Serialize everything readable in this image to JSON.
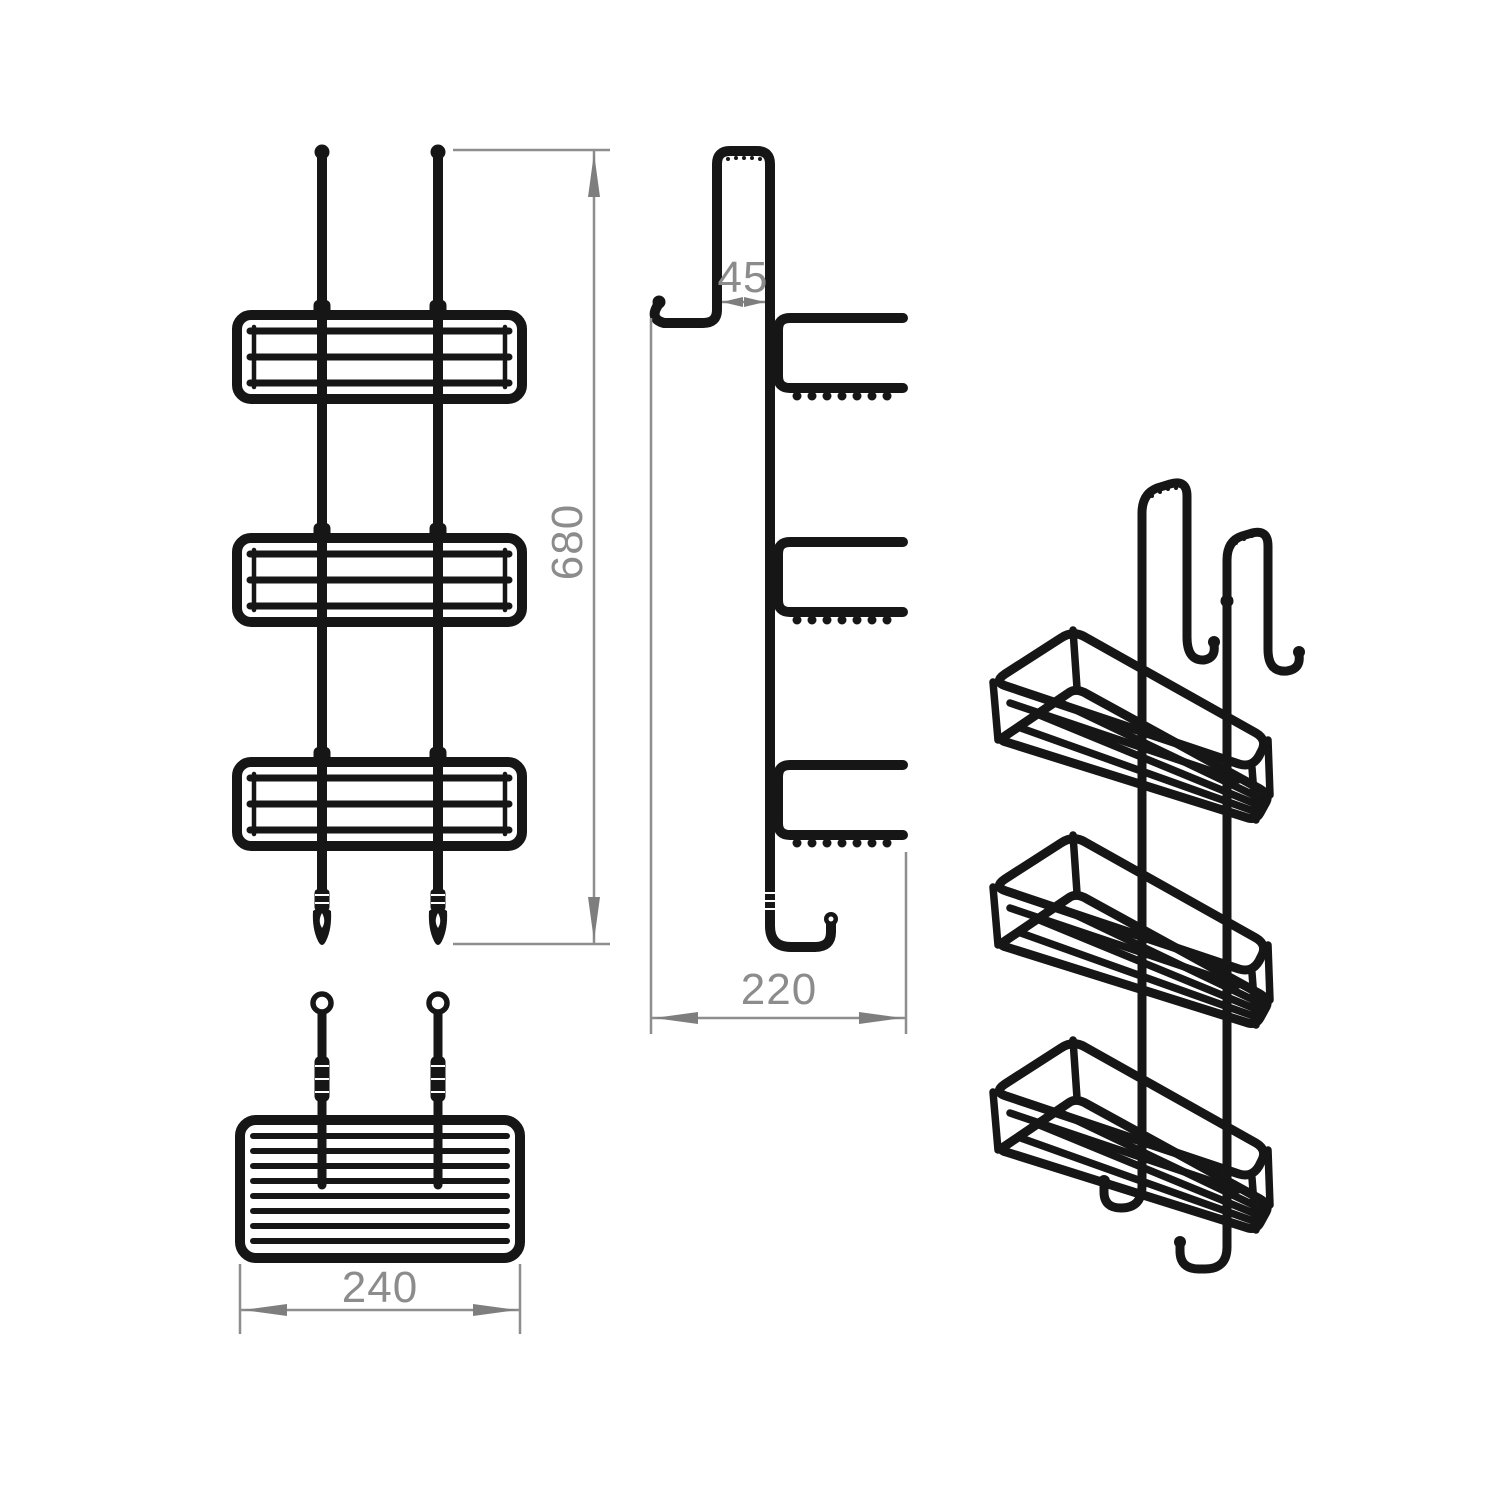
{
  "dimensions": {
    "height": "680",
    "hook_width": "45",
    "depth": "220",
    "width": "240"
  },
  "colors": {
    "line": "#161616",
    "dimension_line": "#8e8e8e",
    "arrow": "#7e7e7e",
    "label": "#8c8c8c",
    "background": "#ffffff"
  }
}
